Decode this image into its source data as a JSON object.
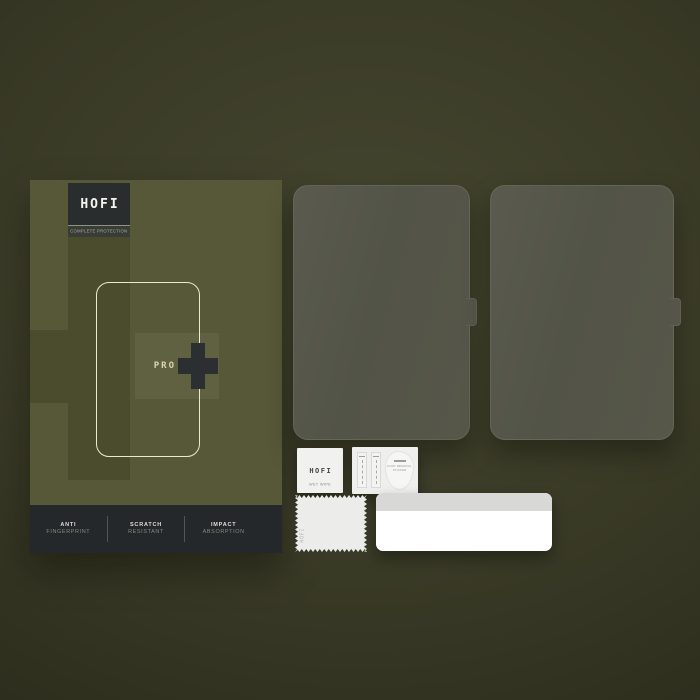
{
  "product": {
    "brand": "HOFI",
    "tagline": "COMPLETE PROTECTION",
    "model": "PRO",
    "plus": "+",
    "features": [
      {
        "line1": "ANTI",
        "line2": "FINGERPRINT"
      },
      {
        "line1": "SCRATCH",
        "line2": "RESISTANT"
      },
      {
        "line1": "IMPACT",
        "line2": "ABSORPTION"
      }
    ]
  },
  "contents": {
    "protector_count": 2,
    "wet_wipe": {
      "brand": "HOFI",
      "label": "WET WIPE"
    },
    "dust_sticker": {
      "line1": "DUST REMOVAL",
      "line2": "STICKER"
    },
    "cloth": {
      "brand": "HOFI"
    }
  },
  "colors": {
    "background": "#3a3b27",
    "box_olive": "#565837",
    "box_dark_band": "#4a4c2d",
    "box_light_band": "#5f6140",
    "charcoal": "#26292b",
    "outline_cream": "#ebe8d4",
    "model_text": "#dcd6ae",
    "glass": "#545649"
  }
}
